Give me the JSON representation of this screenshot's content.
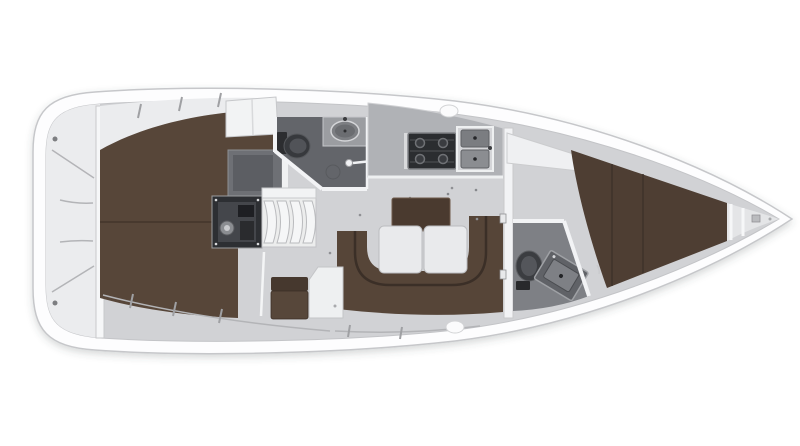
{
  "canvas": {
    "width": 800,
    "height": 446,
    "background": "#ffffff"
  },
  "colors": {
    "hull": "#fdfdfe",
    "hull_outline": "#c6c7ca",
    "inner_line": "#d6d7d9",
    "deck_floor": "#d1d2d5",
    "side_zone": "#ebecee",
    "berth_brown": "#574639",
    "forward_berth_brown": "#4e3e33",
    "settee_brown": "#564538",
    "settee_inner": "#3b2f27",
    "table_brown": "#4a3a2f",
    "table_leaf": "#e9eaec",
    "aft_head_floor": "#63656a",
    "forward_head_floor": "#7e8085",
    "counter_gray": "#9b9da1",
    "galley_counter": "#b0b2b6",
    "engine_dark": "#2d2f33",
    "wardrobe_gray": "#6e7075",
    "fixture_dark": "#37393d",
    "wall_white": "#f2f3f5",
    "steps_white": "#eceded"
  },
  "regions": [
    "hull",
    "transom-storage",
    "aft-cabin-berth",
    "aft-cabin-cabinet",
    "aft-cabin-wardrobe",
    "engine-compartment",
    "companionway-steps",
    "aft-head",
    "aft-head-toilet",
    "aft-head-sink",
    "aft-head-shower",
    "galley",
    "galley-stove",
    "galley-sink",
    "salon-settee",
    "salon-table",
    "nav-seat",
    "step-locker",
    "forward-bulkhead",
    "forward-head",
    "forward-head-toilet",
    "forward-head-sink",
    "forward-cabin-berth",
    "forward-cabin-shelf",
    "anchor-locker"
  ]
}
